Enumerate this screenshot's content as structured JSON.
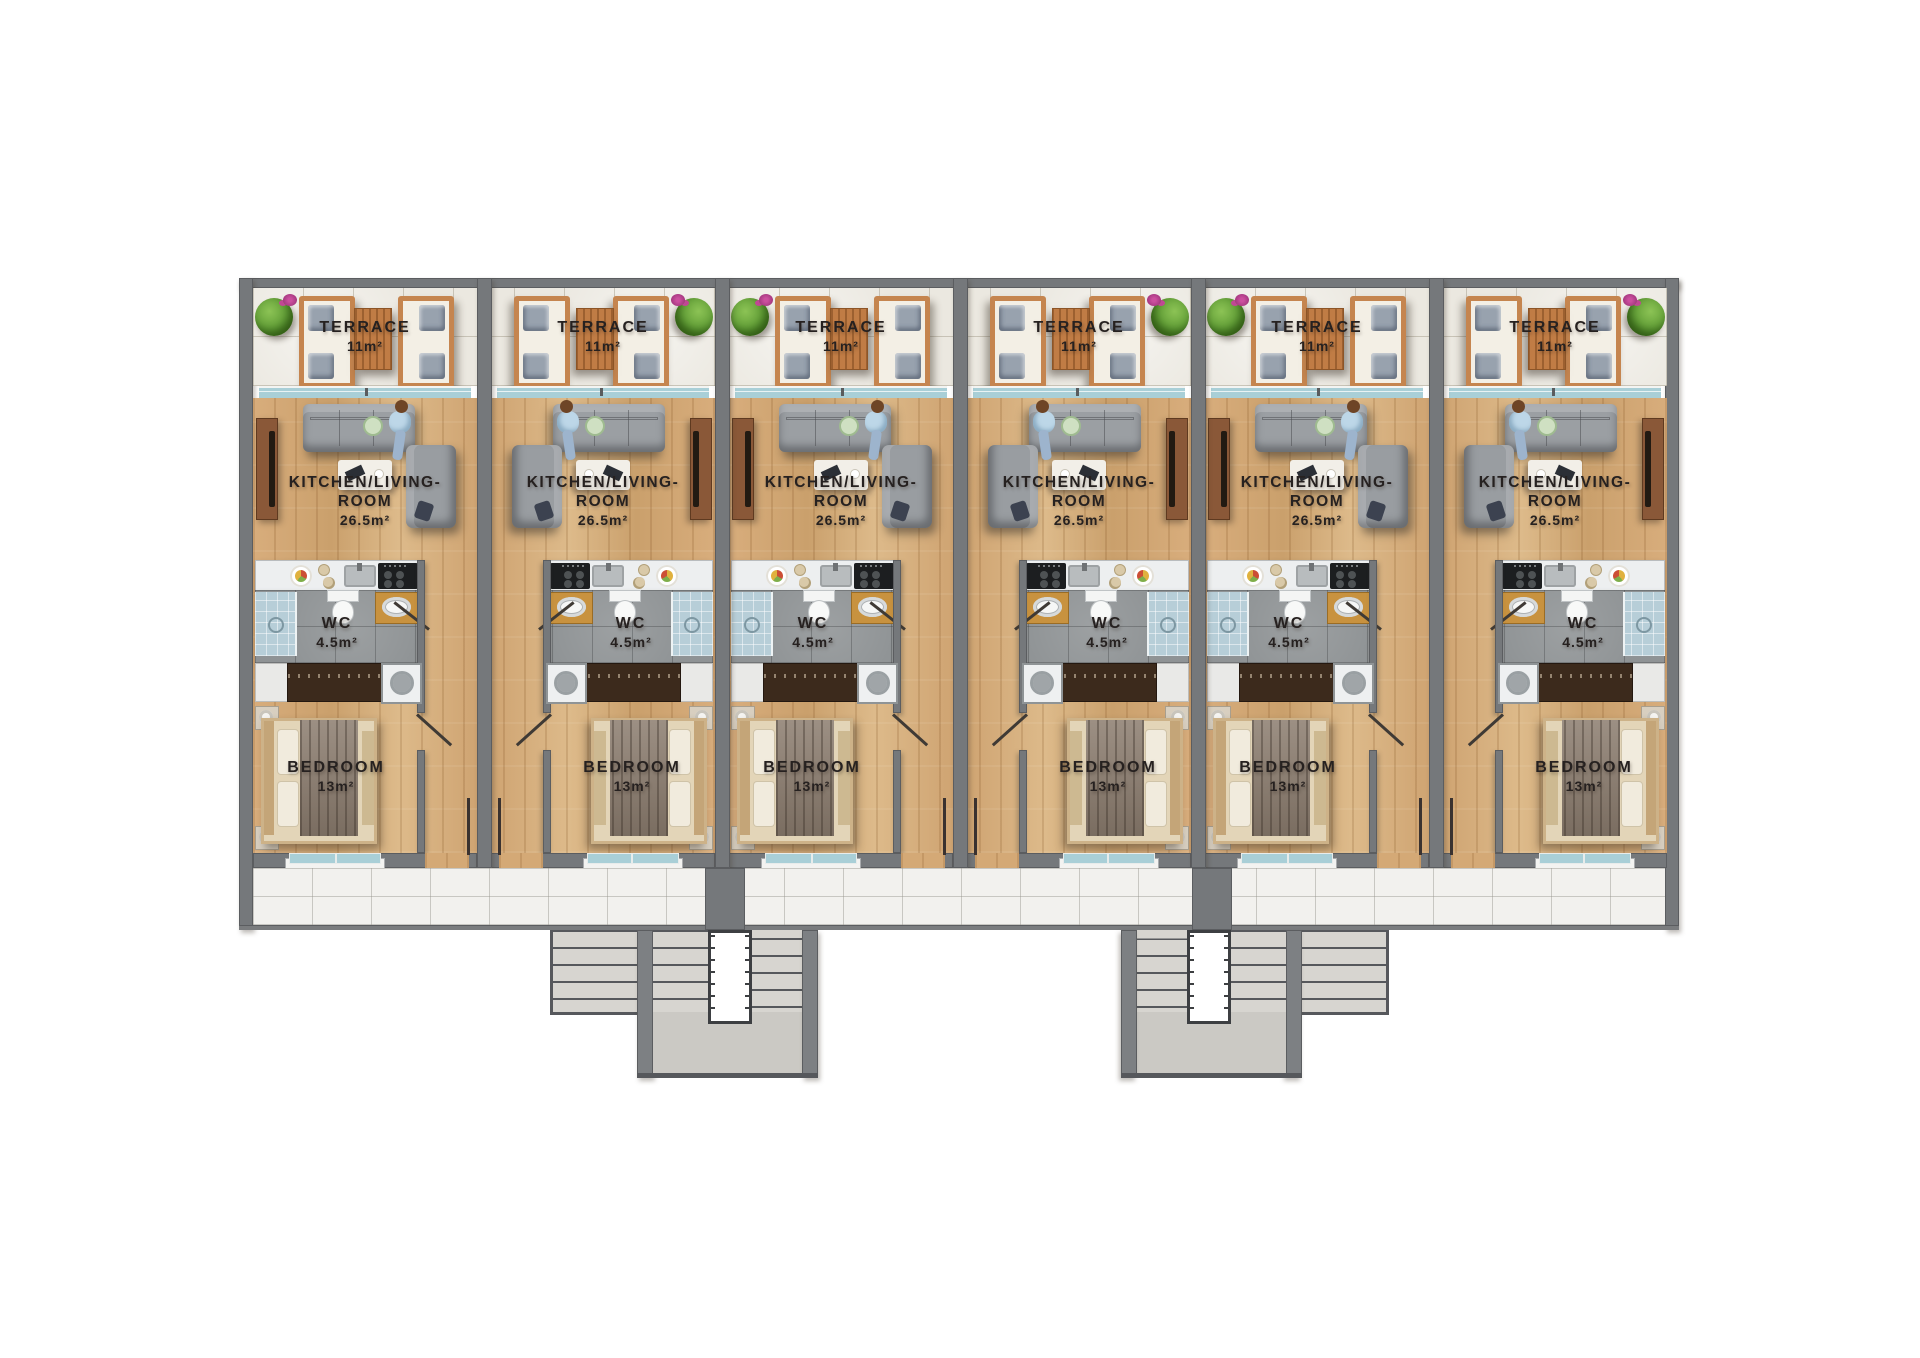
{
  "units": [
    {
      "mirrored": false,
      "terrace": {
        "label": "TERRACE",
        "area": "11m²"
      },
      "living": {
        "label_line1": "KITCHEN/LIVING-",
        "label_line2": "ROOM",
        "area": "26.5m²"
      },
      "wc": {
        "label": "WC",
        "area": "4.5m²"
      },
      "bedroom": {
        "label": "BEDROOM",
        "area": "13m²"
      }
    },
    {
      "mirrored": true,
      "terrace": {
        "label": "TERRACE",
        "area": "11m²"
      },
      "living": {
        "label_line1": "KITCHEN/LIVING-",
        "label_line2": "ROOM",
        "area": "26.5m²"
      },
      "wc": {
        "label": "WC",
        "area": "4.5m²"
      },
      "bedroom": {
        "label": "BEDROOM",
        "area": "13m²"
      }
    },
    {
      "mirrored": false,
      "terrace": {
        "label": "TERRACE",
        "area": "11m²"
      },
      "living": {
        "label_line1": "KITCHEN/LIVING-",
        "label_line2": "ROOM",
        "area": "26.5m²"
      },
      "wc": {
        "label": "WC",
        "area": "4.5m²"
      },
      "bedroom": {
        "label": "BEDROOM",
        "area": "13m²"
      }
    },
    {
      "mirrored": true,
      "terrace": {
        "label": "TERRACE",
        "area": "11m²"
      },
      "living": {
        "label_line1": "KITCHEN/LIVING-",
        "label_line2": "ROOM",
        "area": "26.5m²"
      },
      "wc": {
        "label": "WC",
        "area": "4.5m²"
      },
      "bedroom": {
        "label": "BEDROOM",
        "area": "13m²"
      }
    },
    {
      "mirrored": false,
      "terrace": {
        "label": "TERRACE",
        "area": "11m²"
      },
      "living": {
        "label_line1": "KITCHEN/LIVING-",
        "label_line2": "ROOM",
        "area": "26.5m²"
      },
      "wc": {
        "label": "WC",
        "area": "4.5m²"
      },
      "bedroom": {
        "label": "BEDROOM",
        "area": "13m²"
      }
    },
    {
      "mirrored": true,
      "terrace": {
        "label": "TERRACE",
        "area": "11m²"
      },
      "living": {
        "label_line1": "KITCHEN/LIVING-",
        "label_line2": "ROOM",
        "area": "26.5m²"
      },
      "wc": {
        "label": "WC",
        "area": "4.5m²"
      },
      "bedroom": {
        "label": "BEDROOM",
        "area": "13m²"
      }
    }
  ],
  "colors": {
    "wall": "#75787b",
    "wood_floor": "#d4a976",
    "terrace_tile": "#ebe8e0",
    "walkway_tile": "#f2f1ee",
    "wc_tile": "#8f9395",
    "glass": "#a9cfd7",
    "stair_tread": "#d7d5d0",
    "label_text": "#262120"
  }
}
